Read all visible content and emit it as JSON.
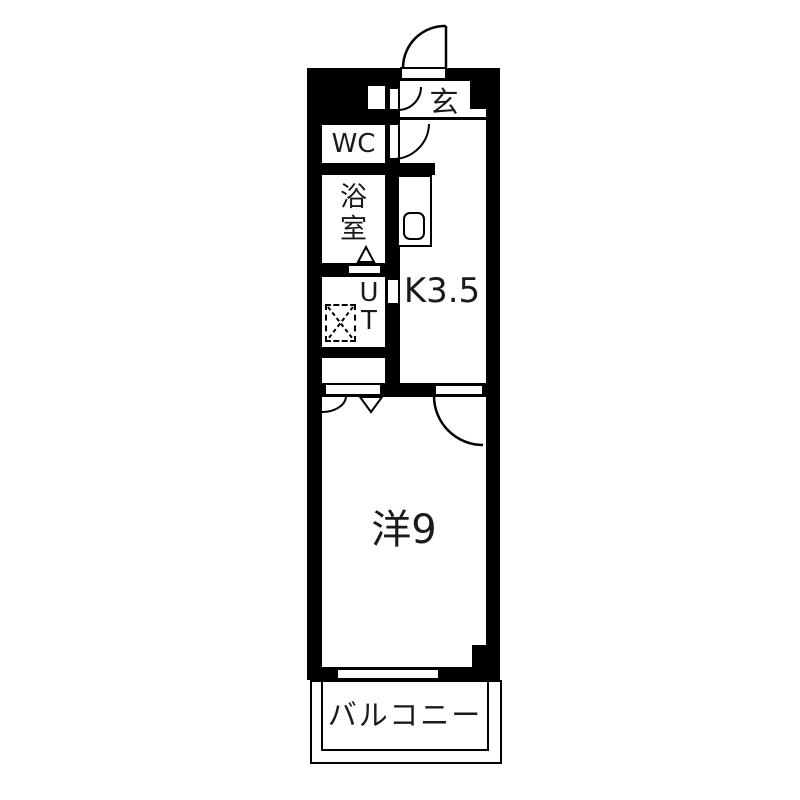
{
  "title": "apartment floor plan",
  "colors": {
    "wall": "#000000",
    "floor": "#ffffff",
    "line": "#000000"
  },
  "rooms": {
    "entrance": {
      "label": "玄"
    },
    "wc": {
      "label": "WC"
    },
    "bathroom": {
      "label": "浴室",
      "chars": [
        "浴",
        "室"
      ]
    },
    "utility": {
      "label": "UT",
      "chars": [
        "U",
        "T"
      ]
    },
    "kitchen": {
      "label": "K3.5"
    },
    "western_room": {
      "label": "洋9"
    },
    "balcony": {
      "label": "バルコニー"
    }
  },
  "symbols": {
    "entrance_door": "hinged-door-swing",
    "wc_door": "hinged-door-swing",
    "shoe_cabinet_door": "hinged-door-swing",
    "kitchen_room_door": "hinged-door-swing",
    "closet_doors": "arc-and-triangle",
    "bath_door_mark": "triangle",
    "laundry_pan": "dashed-box-with-x",
    "kitchen_sink": "rounded-square"
  }
}
